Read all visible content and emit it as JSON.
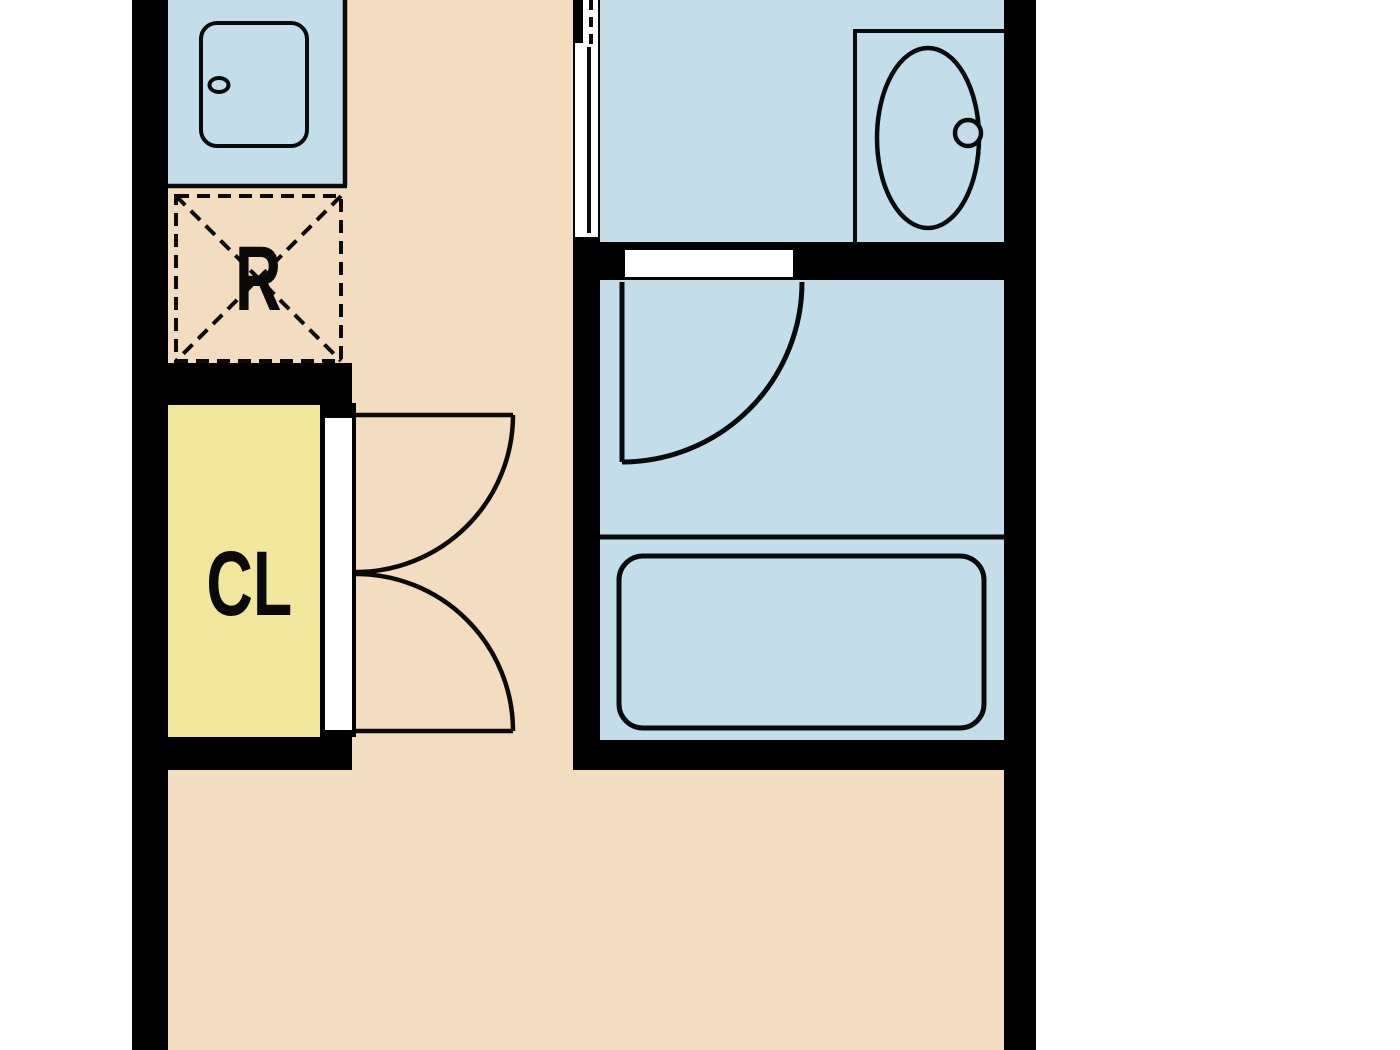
{
  "title": "Apartment unit floor plan",
  "labels": {
    "refrigerator": "R",
    "closet": "CL"
  },
  "colors": {
    "background": "#FFFFFF",
    "floor": "#F3DDC0",
    "wet_rooms": "#C4DEE9",
    "closet": "#F1E79C",
    "walls": "#000000",
    "door": "#FFFFFF",
    "line": "#0A0A0A"
  },
  "fixtures": [
    "kitchen-sink",
    "refrigerator-space",
    "closet-double-door",
    "sliding-door",
    "hinged-door",
    "toilet",
    "bathtub"
  ]
}
